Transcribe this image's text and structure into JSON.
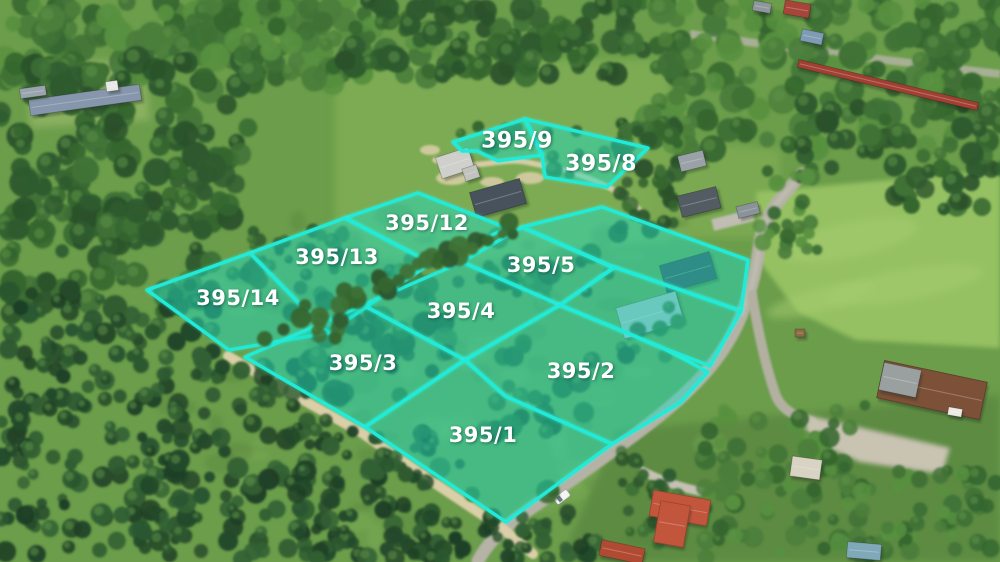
{
  "scene": {
    "type": "aerial-drone-photo-with-parcel-overlay",
    "width": 1000,
    "height": 562
  },
  "overlay": {
    "stroke_color": "#21ebd8",
    "fill_color": "#12d1b6",
    "fill_opacity": 0.34,
    "label_color": "#ffffff",
    "plots": [
      {
        "label": "395/9",
        "label_x": 517,
        "label_y": 141,
        "font_size": 22,
        "points": "453,142 525,119 543,155 520,158 498,161 477,151 462,151"
      },
      {
        "label": "395/8",
        "label_x": 601,
        "label_y": 164,
        "font_size": 22,
        "points": "525,119 648,148 607,187 545,177 542,155"
      },
      {
        "label": "395/12",
        "label_x": 427,
        "label_y": 223,
        "font_size": 21,
        "points": "345,218 418,193 507,228 431,263"
      },
      {
        "label": "395/13",
        "label_x": 337,
        "label_y": 257,
        "font_size": 21,
        "points": "250,253 345,218 431,263 328,333"
      },
      {
        "label": "395/14",
        "label_x": 238,
        "label_y": 298,
        "font_size": 21,
        "points": "147,290 250,253 328,333 229,350"
      },
      {
        "label": "395/5",
        "label_x": 541,
        "label_y": 265,
        "font_size": 21,
        "points": "462,262 522,227 614,268 560,305"
      },
      {
        "label": "395/4",
        "label_x": 461,
        "label_y": 311,
        "font_size": 21,
        "points": "363,305 462,262 560,305 465,360"
      },
      {
        "label": "395/3",
        "label_x": 363,
        "label_y": 363,
        "font_size": 21,
        "points": "245,357 363,305 465,360 365,427"
      },
      {
        "label": "395/2",
        "label_x": 581,
        "label_y": 371,
        "font_size": 21,
        "points": "465,360 560,305 663,348 708,372 680,403 612,444 505,396"
      },
      {
        "label": "395/1",
        "label_x": 483,
        "label_y": 435,
        "font_size": 21,
        "points": "365,427 465,360 505,396 612,444 506,522"
      },
      {
        "label": "",
        "label_x": 0,
        "label_y": 0,
        "font_size": 0,
        "points": "522,227 602,207 748,260 741,311 614,267"
      },
      {
        "label": "",
        "label_x": 0,
        "label_y": 0,
        "font_size": 0,
        "points": "614,267 741,311 710,366 663,348 560,305"
      }
    ]
  },
  "palette": {
    "grass_base": "#6b9d4a",
    "clearing_grass": "#7cab53",
    "meadow": "#95c162",
    "asphalt_road": "#b5b2a6",
    "sand_path": "#dbcfa8",
    "forest_dark": "#2e5a2f",
    "conifer_dark": "#24492a",
    "red_roof": "#c2563c",
    "farm_roof": "#7d5138",
    "slate_roof": "#47525c",
    "barn_roof": "#8696ac"
  }
}
